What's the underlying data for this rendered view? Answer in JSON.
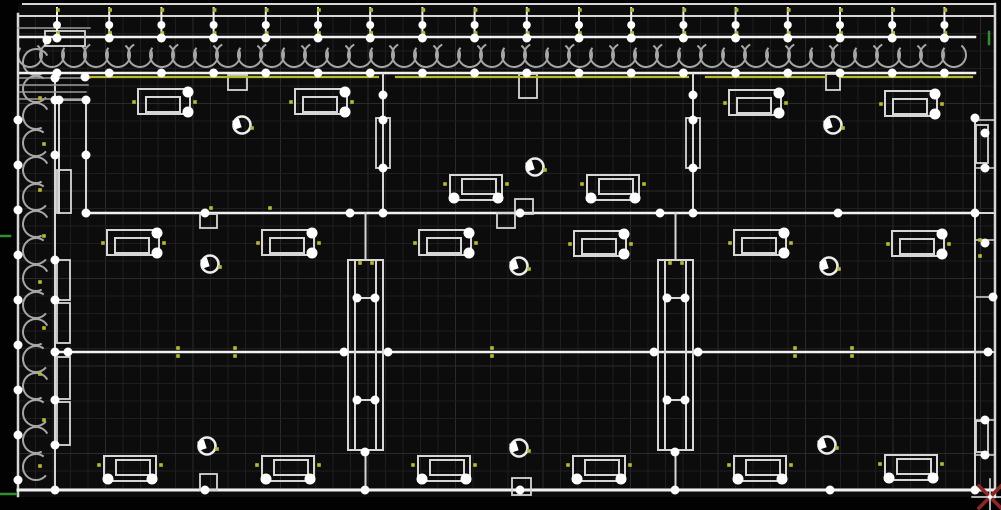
{
  "app": {
    "name": "cad-floorplan-viewport"
  },
  "viewport": {
    "width": 1001,
    "height": 510,
    "grid_step": 17.5
  },
  "palette": {
    "outside_bg": "#020202",
    "canvas_bg": "#0c0c0c",
    "grid": "#1e1e1e",
    "grid_major": "#2a2a2a",
    "wall": "#d6d6d6",
    "wall_bright": "#f1f1f1",
    "wall_dim": "#9b9b9b",
    "insulation": "#a6a6a6",
    "accent_yellow": "#b9b92e",
    "node_white": "#ffffff",
    "green": "#2f8f2f",
    "cursor_red": "#8f2626",
    "cursor_white": "#eaeaea"
  },
  "scene": {
    "canvas_rect": [
      18,
      4,
      977,
      493
    ],
    "frame_lines": [
      [
        23,
        4,
        993,
        4,
        2,
        "wall"
      ],
      [
        18,
        16,
        993,
        16,
        2,
        "wall"
      ],
      [
        18,
        14,
        18,
        496,
        2.5,
        "wall"
      ],
      [
        995,
        4,
        995,
        497,
        2.5,
        "wall"
      ],
      [
        18,
        490,
        995,
        490,
        3,
        "wall_bright"
      ]
    ],
    "walls": [
      [
        20,
        37,
        975,
        37,
        2.5,
        "wall_bright"
      ],
      [
        20,
        73,
        975,
        73,
        2.5,
        "wall_bright"
      ],
      [
        55,
        75,
        55,
        492,
        2,
        "wall"
      ],
      [
        86,
        213,
        975,
        213,
        2.5,
        "wall_bright"
      ],
      [
        55,
        352,
        988,
        352,
        2.5,
        "wall_bright"
      ],
      [
        383,
        74,
        383,
        213,
        2,
        "wall"
      ],
      [
        693,
        74,
        693,
        213,
        2,
        "wall"
      ],
      [
        975,
        118,
        975,
        490,
        2,
        "wall"
      ],
      [
        59,
        100,
        59,
        213,
        2,
        "wall"
      ],
      [
        86,
        100,
        86,
        213,
        2,
        "wall"
      ],
      [
        55,
        100,
        86,
        100,
        1.5,
        "wall"
      ],
      [
        18,
        28,
        90,
        28,
        1.5,
        "wall_dim"
      ],
      [
        20,
        78,
        90,
        78,
        1.5,
        "wall_dim"
      ],
      [
        20,
        85,
        88,
        85,
        1.5,
        "wall_dim"
      ],
      [
        20,
        92,
        86,
        92,
        1.5,
        "wall_dim"
      ],
      [
        20,
        99,
        86,
        99,
        1.5,
        "wall_dim"
      ],
      [
        975,
        120,
        995,
        120,
        1.5,
        "wall"
      ],
      [
        975,
        168,
        995,
        168,
        1.5,
        "wall"
      ],
      [
        975,
        213,
        995,
        213,
        2,
        "wall"
      ],
      [
        975,
        240,
        995,
        240,
        1.5,
        "wall"
      ],
      [
        975,
        297,
        995,
        297,
        1.5,
        "wall"
      ],
      [
        975,
        352,
        995,
        352,
        2,
        "wall"
      ],
      [
        975,
        420,
        995,
        420,
        1.5,
        "wall"
      ],
      [
        975,
        455,
        995,
        455,
        1.5,
        "wall"
      ]
    ],
    "yellow_lines": [
      [
        85,
        77,
        378,
        77
      ],
      [
        396,
        77,
        688,
        77
      ],
      [
        706,
        77,
        826,
        77
      ],
      [
        840,
        77,
        972,
        77
      ]
    ],
    "ticks": {
      "start": 57,
      "step": 52.2,
      "count": 18,
      "top": 8,
      "bottom": 36,
      "wall_top": 38,
      "wall_bottom": 73
    },
    "insulation_top": {
      "x1": 30,
      "x2": 972,
      "y": 55,
      "step": 22,
      "r": 12
    },
    "insulation_left": {
      "y1": 62,
      "y2": 482,
      "x": 36,
      "step": 27,
      "r": 13
    },
    "shafts": [
      {
        "x": 348,
        "y1": 260,
        "y2": 450,
        "w": 35,
        "inner": 7,
        "rungs": [
          298,
          400
        ],
        "stub_top": [
          213,
          260
        ],
        "stub_bottom": [
          450,
          490
        ]
      },
      {
        "x": 658,
        "y1": 260,
        "y2": 450,
        "w": 35,
        "inner": 7,
        "rungs": [
          298,
          400
        ],
        "stub_top": [
          213,
          260
        ],
        "stub_bottom": [
          450,
          490
        ]
      }
    ],
    "rects": [
      [
        45,
        31,
        40,
        15
      ],
      [
        376,
        118,
        14,
        50
      ],
      [
        686,
        118,
        14,
        50
      ],
      [
        57,
        170,
        14,
        43
      ],
      [
        57,
        260,
        13,
        40
      ],
      [
        57,
        303,
        13,
        40
      ],
      [
        57,
        357,
        13,
        42
      ],
      [
        57,
        402,
        13,
        43
      ],
      [
        228,
        75,
        19,
        15
      ],
      [
        519,
        74,
        18,
        24
      ],
      [
        826,
        74,
        14,
        16
      ],
      [
        200,
        214,
        17,
        14
      ],
      [
        515,
        199,
        18,
        15
      ],
      [
        497,
        213,
        18,
        15
      ],
      [
        200,
        474,
        17,
        16
      ],
      [
        512,
        478,
        19,
        17
      ],
      [
        976,
        125,
        12,
        38
      ],
      [
        976,
        421,
        12,
        31
      ]
    ],
    "fixtures": [
      {
        "x": 164,
        "y": 102,
        "o": "R"
      },
      {
        "x": 321,
        "y": 102,
        "o": "R"
      },
      {
        "x": 476,
        "y": 188,
        "o": "B"
      },
      {
        "x": 613,
        "y": 188,
        "o": "B"
      },
      {
        "x": 755,
        "y": 103,
        "o": "R"
      },
      {
        "x": 911,
        "y": 104,
        "o": "R"
      },
      {
        "x": 133,
        "y": 243,
        "o": "R"
      },
      {
        "x": 288,
        "y": 243,
        "o": "R"
      },
      {
        "x": 445,
        "y": 243,
        "o": "R"
      },
      {
        "x": 600,
        "y": 244,
        "o": "R"
      },
      {
        "x": 760,
        "y": 243,
        "o": "R"
      },
      {
        "x": 918,
        "y": 244,
        "o": "R"
      },
      {
        "x": 130,
        "y": 469,
        "o": "B"
      },
      {
        "x": 288,
        "y": 469,
        "o": "B"
      },
      {
        "x": 444,
        "y": 469,
        "o": "B"
      },
      {
        "x": 599,
        "y": 469,
        "o": "B"
      },
      {
        "x": 760,
        "y": 469,
        "o": "B"
      },
      {
        "x": 911,
        "y": 468,
        "o": "B"
      }
    ],
    "circles": [
      [
        242,
        125
      ],
      [
        535,
        167
      ],
      [
        833,
        125
      ],
      [
        210,
        264
      ],
      [
        519,
        266
      ],
      [
        829,
        266
      ],
      [
        207,
        446
      ],
      [
        519,
        448
      ],
      [
        827,
        445
      ]
    ],
    "nodes": [
      [
        86,
        213
      ],
      [
        205,
        213
      ],
      [
        350,
        213
      ],
      [
        383,
        213
      ],
      [
        520,
        213
      ],
      [
        660,
        213
      ],
      [
        693,
        213
      ],
      [
        838,
        213
      ],
      [
        975,
        213
      ],
      [
        68,
        352
      ],
      [
        344,
        352
      ],
      [
        388,
        352
      ],
      [
        654,
        352
      ],
      [
        698,
        352
      ],
      [
        988,
        352
      ],
      [
        55,
        490
      ],
      [
        205,
        490
      ],
      [
        365,
        490
      ],
      [
        520,
        490
      ],
      [
        675,
        490
      ],
      [
        830,
        490
      ],
      [
        975,
        490
      ],
      [
        18,
        120
      ],
      [
        18,
        165
      ],
      [
        18,
        210
      ],
      [
        18,
        255
      ],
      [
        18,
        300
      ],
      [
        18,
        345
      ],
      [
        18,
        390
      ],
      [
        18,
        435
      ],
      [
        18,
        480
      ],
      [
        55,
        78
      ],
      [
        55,
        100
      ],
      [
        55,
        155
      ],
      [
        55,
        260
      ],
      [
        55,
        300
      ],
      [
        55,
        352
      ],
      [
        55,
        400
      ],
      [
        55,
        445
      ],
      [
        86,
        100
      ],
      [
        86,
        155
      ],
      [
        59,
        100
      ],
      [
        47,
        40
      ],
      [
        85,
        77
      ],
      [
        383,
        95
      ],
      [
        383,
        120
      ],
      [
        383,
        168
      ],
      [
        693,
        95
      ],
      [
        693,
        120
      ],
      [
        693,
        168
      ],
      [
        357,
        298
      ],
      [
        375,
        298
      ],
      [
        357,
        400
      ],
      [
        375,
        400
      ],
      [
        365,
        452
      ],
      [
        667,
        298
      ],
      [
        685,
        298
      ],
      [
        667,
        400
      ],
      [
        685,
        400
      ],
      [
        675,
        452
      ],
      [
        975,
        118
      ],
      [
        985,
        133
      ],
      [
        985,
        168
      ],
      [
        985,
        243
      ],
      [
        993,
        297
      ],
      [
        985,
        420
      ],
      [
        985,
        455
      ]
    ],
    "yellow_dots": [
      [
        178,
        348
      ],
      [
        178,
        356
      ],
      [
        235,
        348
      ],
      [
        235,
        356
      ],
      [
        492,
        348
      ],
      [
        492,
        356
      ],
      [
        795,
        348
      ],
      [
        795,
        356
      ],
      [
        852,
        348
      ],
      [
        852,
        356
      ],
      [
        211,
        208
      ],
      [
        270,
        208
      ],
      [
        360,
        263
      ],
      [
        372,
        263
      ],
      [
        670,
        263
      ],
      [
        682,
        263
      ],
      [
        980,
        240
      ],
      [
        980,
        256
      ],
      [
        40,
        98
      ],
      [
        44,
        144
      ],
      [
        40,
        190
      ],
      [
        44,
        236
      ],
      [
        40,
        282
      ],
      [
        44,
        328
      ],
      [
        40,
        374
      ],
      [
        44,
        420
      ],
      [
        40,
        466
      ]
    ],
    "green_segments": [
      [
        0,
        236,
        10,
        236
      ],
      [
        0,
        494,
        16,
        494
      ],
      [
        989,
        32,
        989,
        44
      ]
    ],
    "cursor": {
      "x": 990,
      "y": 497,
      "arm": 18,
      "x_size": 11
    }
  }
}
